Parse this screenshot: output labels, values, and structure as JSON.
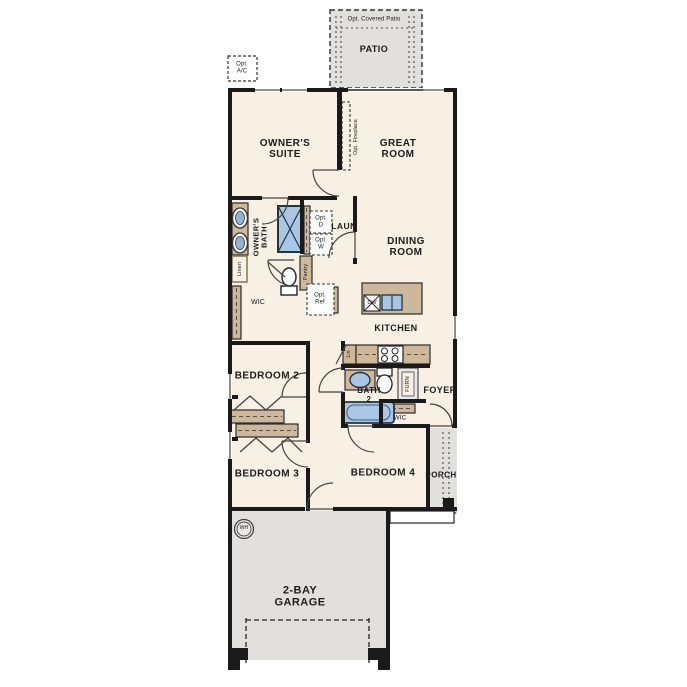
{
  "colors": {
    "wall": "#1a1a1a",
    "floor": "#f7f0e3",
    "concrete": "#e1e0dd",
    "cabinet": "#cdb89b",
    "fixture_blue": "#a9c6e2"
  },
  "labels": {
    "opt_covered_patio": "Opt. Covered Patio",
    "patio": "PATIO",
    "opt_ac": "Opt.\nA/C",
    "owners_suite": "OWNER'S\nSUITE",
    "great_room": "GREAT\nROOM",
    "opt_fireplace": "Opt. Fireplace",
    "owners_bath": "OWNER'S\nBATH",
    "opt_d": "Opt.\nD",
    "opt_w": "Opt.\nW",
    "laun": "LAUN",
    "linen": "Linen",
    "pantry": "Pantry",
    "wic_owner": "WIC",
    "opt_ref": "Opt.\nRef",
    "dining_room": "DINING\nROOM",
    "dw": "DW",
    "kitchen": "KITCHEN",
    "lin": "Lin",
    "bath_2": "BATH\n2",
    "furn": "FURN",
    "foyer": "FOYER",
    "wic_foyer": "WIC",
    "bedroom_2": "BEDROOM 2",
    "bedroom_3": "BEDROOM 3",
    "bedroom_4": "BEDROOM 4",
    "porch": "PORCH",
    "wh": "WH",
    "garage": "2-BAY\nGARAGE"
  }
}
